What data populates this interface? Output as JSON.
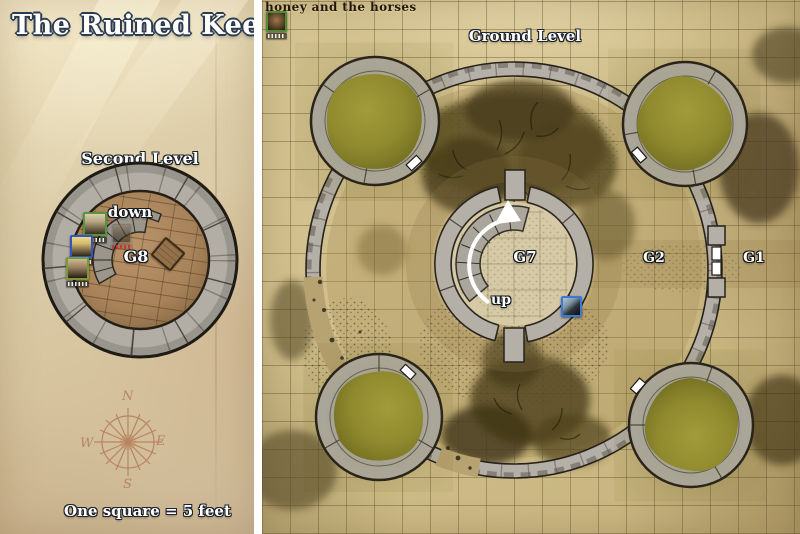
{
  "left_panel": {
    "title": "The Ruined Keep",
    "level_label": "Second Level",
    "scale_label": "One square = 5 feet",
    "map_labels": {
      "stairs": "down",
      "room": "G8"
    },
    "compass": {
      "north": "N",
      "east": "E",
      "south": "S",
      "west": "W"
    },
    "tokens": [
      {
        "id": "pc-token-1",
        "border_color": "#57953a"
      },
      {
        "id": "pc-token-2",
        "border_color": "#3056c8"
      },
      {
        "id": "pc-token-3",
        "border_color": "#7a9a3a"
      },
      {
        "id": "faded-npc-token",
        "border_color": "#6f6a60",
        "name_color": "#c03a30"
      }
    ]
  },
  "right_panel": {
    "campaign_header": "honey and the horses",
    "level_label": "Ground Level",
    "map_labels": {
      "center_room": "G7",
      "stairs": "up",
      "ward_inner": "G2",
      "ward_outer": "G1"
    },
    "tokens": [
      {
        "id": "corner-creature-token",
        "border_color": "#4d8c33"
      },
      {
        "id": "raven-token",
        "border_color": "#3b79d8"
      }
    ]
  },
  "colors": {
    "parchment_left": "#dccda8",
    "parchment_grid": "#cfbd8a",
    "stone_wall": "#b4b0a7",
    "wall_outline": "#26221b",
    "tower_cover_green": "#8f8a2e",
    "wood_floor": "#aa865e",
    "brush_dark_olive": "#4a3e1c",
    "label_text": "#ffffff",
    "header_text": "#241708",
    "compass_ink": "#a65f3e"
  }
}
